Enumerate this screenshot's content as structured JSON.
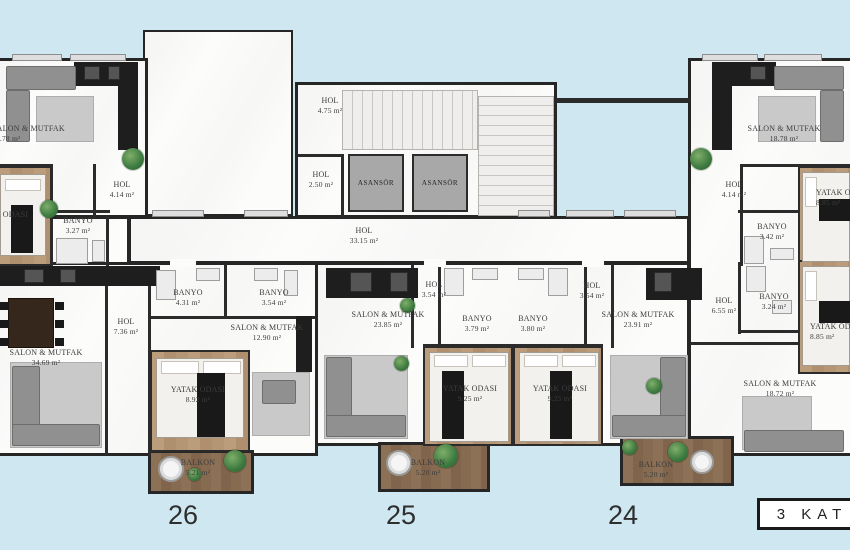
{
  "colors": {
    "background": "#cee7f1",
    "walls": "#262626",
    "floor": "#fcfcfb",
    "bedroom_wood": "#b08f6e",
    "balcony_wood": "#80654c",
    "elevator_fill": "#a8a8a8"
  },
  "elevator_label": "ASANSÖR",
  "floor_badge": "3 KAT",
  "unit_numbers": [
    "26",
    "25",
    "24"
  ],
  "rooms": [
    {
      "label": "SALON & MUTFAK",
      "area": "18.78 m²"
    },
    {
      "label": "HOL",
      "area": "4.14 m²"
    },
    {
      "label": "BANYO",
      "area": "3.27 m²"
    },
    {
      "label": "YATAK ODASI",
      "area": "8.85 m²"
    },
    {
      "label": "SALON & MUTFAK",
      "area": "34.69 m²"
    },
    {
      "label": "HOL",
      "area": "7.36 m²"
    },
    {
      "label": "BANYO",
      "area": "4.31 m²"
    },
    {
      "label": "BANYO",
      "area": "3.54 m²"
    },
    {
      "label": "SALON & MUTFAK",
      "area": "12.90 m²"
    },
    {
      "label": "YATAK ODASI",
      "area": "8.92 m²"
    },
    {
      "label": "BALKON",
      "area": "5.21 m²"
    },
    {
      "label": "HOL",
      "area": "4.75 m²"
    },
    {
      "label": "HOL",
      "area": "2.50 m²"
    },
    {
      "label": "HOL",
      "area": "33.15 m²"
    },
    {
      "label": "HOL",
      "area": "3.54 m²"
    },
    {
      "label": "SALON & MUTFAK",
      "area": "23.85 m²"
    },
    {
      "label": "BANYO",
      "area": "3.79 m²"
    },
    {
      "label": "BANYO",
      "area": "3.80 m²"
    },
    {
      "label": "YATAK ODASI",
      "area": "9.25 m²"
    },
    {
      "label": "BALKON",
      "area": "5.20 m²"
    },
    {
      "label": "HOL",
      "area": "3.54 m²"
    },
    {
      "label": "SALON & MUTFAK",
      "area": "23.91 m²"
    },
    {
      "label": "YATAK ODASI",
      "area": "9.25 m²"
    },
    {
      "label": "HOL",
      "area": "6.55 m²"
    },
    {
      "label": "BANYO",
      "area": "3.24 m²"
    },
    {
      "label": "SALON & MUTFAK",
      "area": "18.72 m²"
    },
    {
      "label": "BALKON",
      "area": "5.20 m²"
    },
    {
      "label": "SALON & MUTFAK",
      "area": "18.78 m²"
    },
    {
      "label": "HOL",
      "area": "4.14 m²"
    },
    {
      "label": "BANYO",
      "area": "3.42 m²"
    },
    {
      "label": "YATAK ODASI",
      "area": "8.85 m²"
    },
    {
      "label": "YATAK ODASI",
      "area": "8.85 m²"
    }
  ]
}
